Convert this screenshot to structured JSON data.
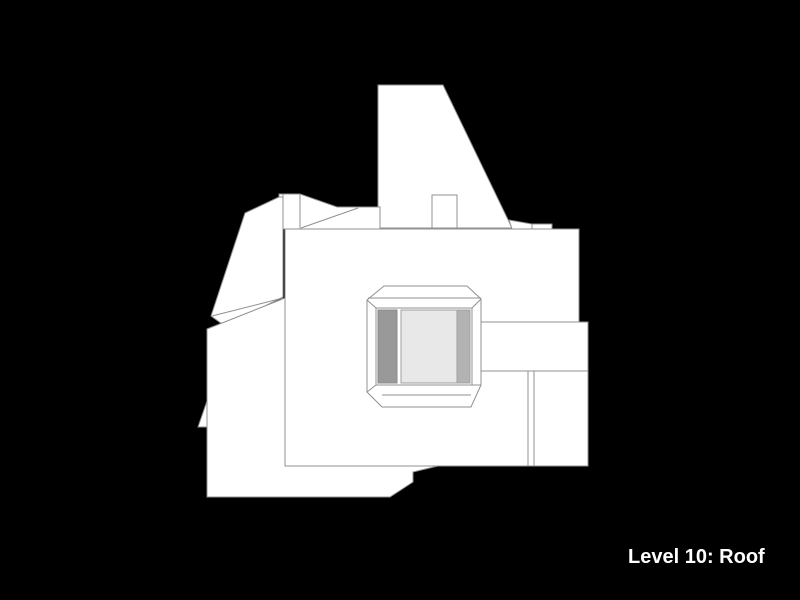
{
  "slide": {
    "background_color": "#000000",
    "caption": {
      "text": "Level 10: Roof",
      "color": "#ffffff"
    },
    "drawing": {
      "type": "architectural-roof-plan",
      "canvas": {
        "width": 800,
        "height": 600
      },
      "fill_color": "#ffffff",
      "line_color": "#909090",
      "skylight_colors": {
        "dark_band": "#999999",
        "glass_center": "#e8e8e8",
        "right_band": "#b3b3b3"
      },
      "polygons": [
        {
          "name": "tower-roof",
          "points": "378,85 443,85 512,228 378,228",
          "fill": "#ffffff",
          "stroke": "#909090"
        },
        {
          "name": "upper-band-roof",
          "points": "279,194 300,194 337,207 380,207 380,229 279,229",
          "fill": "#ffffff",
          "stroke": "#909090"
        },
        {
          "name": "left-upper-roof",
          "points": "245,213 279,197 283,197 283,297 225,326 211,316",
          "fill": "#ffffff",
          "stroke": "#909090"
        },
        {
          "name": "left-lower-roof",
          "points": "207,329 290,296 290,466 438,466 413,472 413,482 390,497 207,497",
          "fill": "#ffffff",
          "stroke": "#909090"
        },
        {
          "name": "left-edge-triangle",
          "points": "207,401 198,427 207,427",
          "fill": "#ffffff",
          "stroke": "#909090"
        },
        {
          "name": "main-roof",
          "points": "285,229 579,229 579,322 588,322 588,466 285,466",
          "fill": "#ffffff",
          "stroke": "#909090"
        },
        {
          "name": "parapet-quad",
          "points": "509,220 532,224 532,229 512,229",
          "fill": "#ffffff",
          "stroke": "#909090"
        },
        {
          "name": "parapet-step",
          "points": "532,224 552,224 552,229 532,229",
          "fill": "#ffffff",
          "stroke": "#909090"
        },
        {
          "name": "stair-bulkhead",
          "points": "432,195 457,195 457,228 432,228",
          "fill": "#ffffff",
          "stroke": "#909090"
        },
        {
          "name": "skylight-curb",
          "points": "384,286 467,286 481,299 481,385 471,407 382,407 367,392 367,300",
          "fill": "#ffffff",
          "stroke": "#909090"
        },
        {
          "name": "skylight-frame",
          "points": "376,308 472,308 472,385 376,385",
          "fill": "#ffffff",
          "stroke": "#909090"
        },
        {
          "name": "skylight-dark-band",
          "points": "378,310 397,310 397,383 378,383",
          "fill": "#999999",
          "stroke": "#8a8a8a"
        },
        {
          "name": "skylight-glass",
          "points": "401,310 457,310 457,383 401,383",
          "fill": "#e8e8e8",
          "stroke": "#a0a0a0"
        },
        {
          "name": "skylight-right-band",
          "points": "457,310 470,310 470,383 457,383",
          "fill": "#b3b3b3",
          "stroke": "#a0a0a0"
        }
      ],
      "lines": [
        {
          "name": "roof-step-line-upper",
          "x1": 481,
          "y1": 322,
          "x2": 579,
          "y2": 322
        },
        {
          "name": "roof-step-line-lower",
          "x1": 481,
          "y1": 371,
          "x2": 588,
          "y2": 371
        },
        {
          "name": "roof-seam-vertical-1",
          "x1": 528,
          "y1": 371,
          "x2": 528,
          "y2": 466
        },
        {
          "name": "roof-seam-vertical-2",
          "x1": 534,
          "y1": 371,
          "x2": 534,
          "y2": 466
        },
        {
          "name": "band-seam-1",
          "x1": 283,
          "y1": 194,
          "x2": 283,
          "y2": 229
        },
        {
          "name": "band-seam-2",
          "x1": 300,
          "y1": 194,
          "x2": 300,
          "y2": 229
        },
        {
          "name": "band-diagonal-fold",
          "x1": 301,
          "y1": 228,
          "x2": 358,
          "y2": 208
        },
        {
          "name": "left-roof-fold",
          "x1": 212,
          "y1": 316,
          "x2": 283,
          "y2": 298
        },
        {
          "name": "curb-inner-top-edge",
          "x1": 368,
          "y1": 298,
          "x2": 481,
          "y2": 298
        },
        {
          "name": "curb-inner-bottom-edge",
          "x1": 382,
          "y1": 395,
          "x2": 471,
          "y2": 395
        },
        {
          "name": "curb-bevel-top-left",
          "x1": 367,
          "y1": 300,
          "x2": 376,
          "y2": 308
        },
        {
          "name": "curb-bevel-top-right",
          "x1": 481,
          "y1": 299,
          "x2": 472,
          "y2": 308
        },
        {
          "name": "curb-bevel-bottom-left",
          "x1": 367,
          "y1": 392,
          "x2": 376,
          "y2": 385
        },
        {
          "name": "curb-bevel-bottom-right",
          "x1": 481,
          "y1": 385,
          "x2": 472,
          "y2": 385
        }
      ]
    }
  }
}
